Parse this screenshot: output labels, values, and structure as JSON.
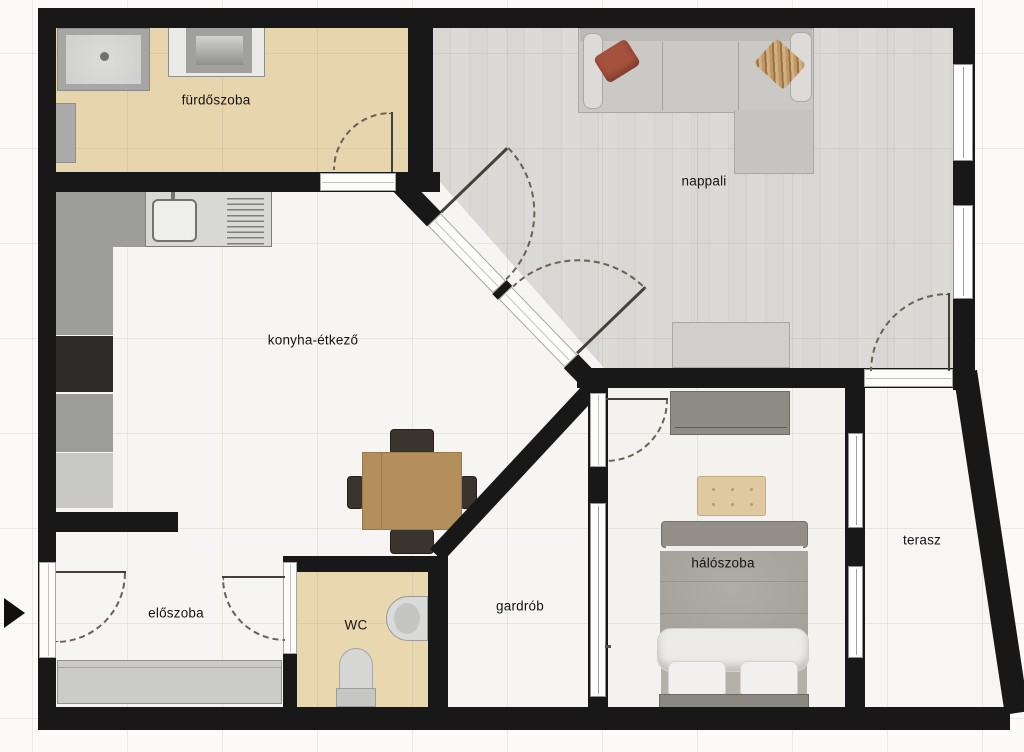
{
  "floorplan": {
    "type": "apartment-floor-plan",
    "rooms": [
      {
        "id": "furdoszoba",
        "label": "fürdőszoba"
      },
      {
        "id": "nappali",
        "label": "nappali"
      },
      {
        "id": "konyha-etkezo",
        "label": "konyha-étkező"
      },
      {
        "id": "eloszoba",
        "label": "előszoba"
      },
      {
        "id": "wc",
        "label": "WC"
      },
      {
        "id": "gardrob",
        "label": "gardrób"
      },
      {
        "id": "haloszoba",
        "label": "hálószoba"
      },
      {
        "id": "terasz",
        "label": "terasz"
      }
    ],
    "icons": {
      "entrance_arrow": "▶"
    },
    "colors": {
      "wall": "#181818",
      "bathroom_floor": "#e7d5ad",
      "living_room_floor": "#d8d6d3",
      "bedroom_floor": "#f3f2ef",
      "generic_floor": "#f6f5f3",
      "label_text": "#141414",
      "sofa": "#cac9c6",
      "accent_pillow": "#a4513d",
      "table_wood": "#b28f5b",
      "door_arc": "#6b6156"
    }
  }
}
